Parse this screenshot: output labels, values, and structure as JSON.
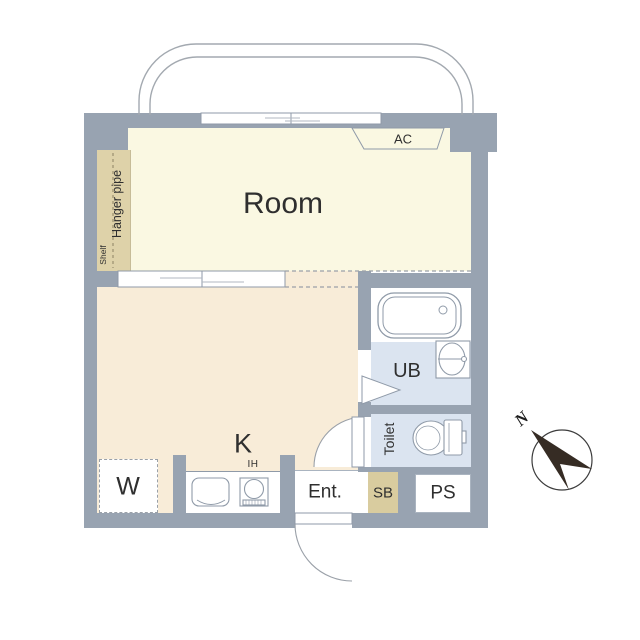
{
  "plan": {
    "rooms": {
      "room": "Room",
      "kitchen": "K",
      "unit_bath": "UB",
      "toilet": "Toilet",
      "entrance": "Ent.",
      "shoe_box": "SB",
      "pipe_space": "PS",
      "washer": "W"
    },
    "fixtures": {
      "air_conditioner": "AC",
      "ih_stove": "IH",
      "hanger_pipe": "Hanger pipe",
      "shelf": "Shelf"
    },
    "compass": {
      "north": "N",
      "direction": "northwest"
    },
    "colors": {
      "wall": "#98a3b1",
      "room-floor": "#faf8e2",
      "kitchen-floor": "#f8ecd8",
      "closet": "#ded2a9",
      "wet-area": "#dbe4f0",
      "shoe-box": "#d9cc9f",
      "line": "#8f9aa8",
      "text": "#2f2f2f"
    }
  }
}
